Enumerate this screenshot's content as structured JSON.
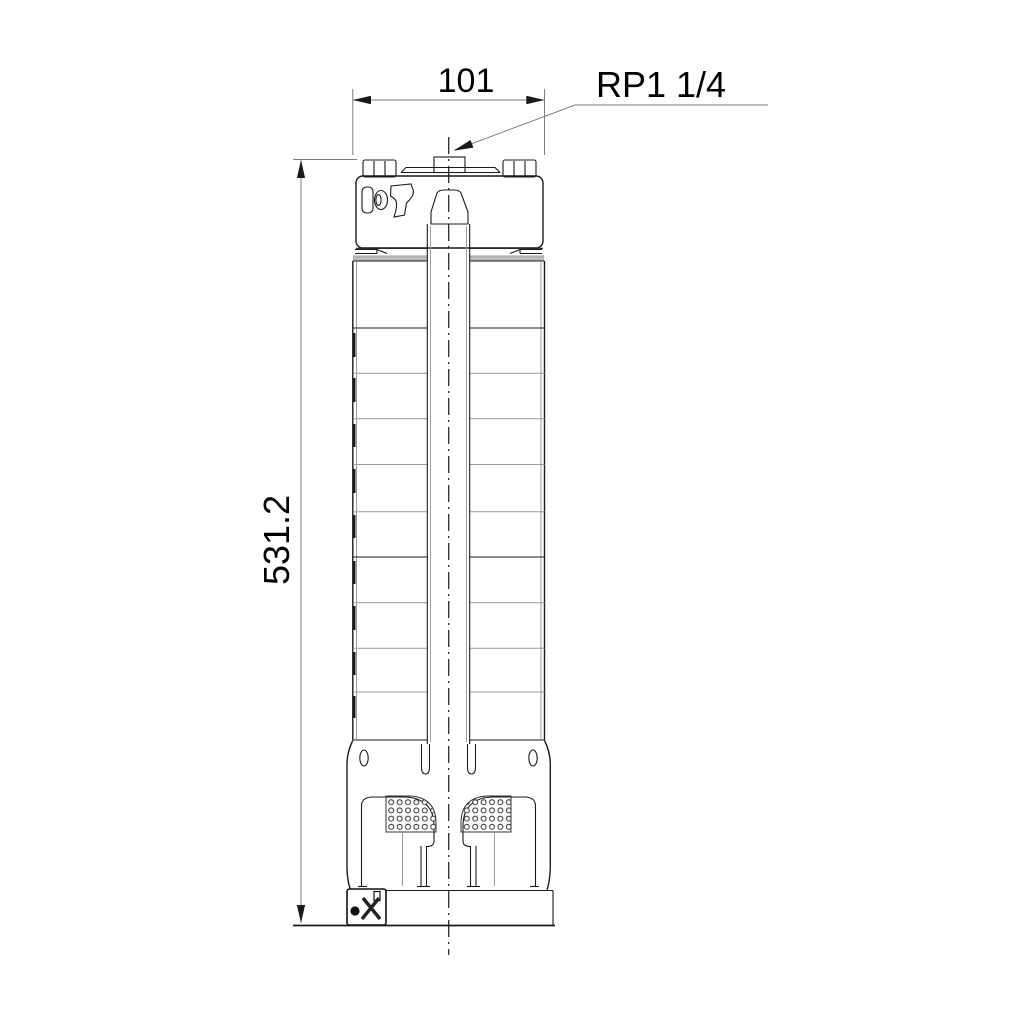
{
  "drawing": {
    "title": "submersible-pump-dimensional-drawing",
    "dimensions": {
      "width_label": "101",
      "height_label": "531.2",
      "connection_label": "RP1 1/4"
    },
    "colors": {
      "outline": "#1a1a1a",
      "secondary_line": "#9c9c9c",
      "dimension_line": "#7d7d7d",
      "band_fill": "#bdbdbd",
      "background": "#ffffff",
      "text": "#000000"
    }
  }
}
